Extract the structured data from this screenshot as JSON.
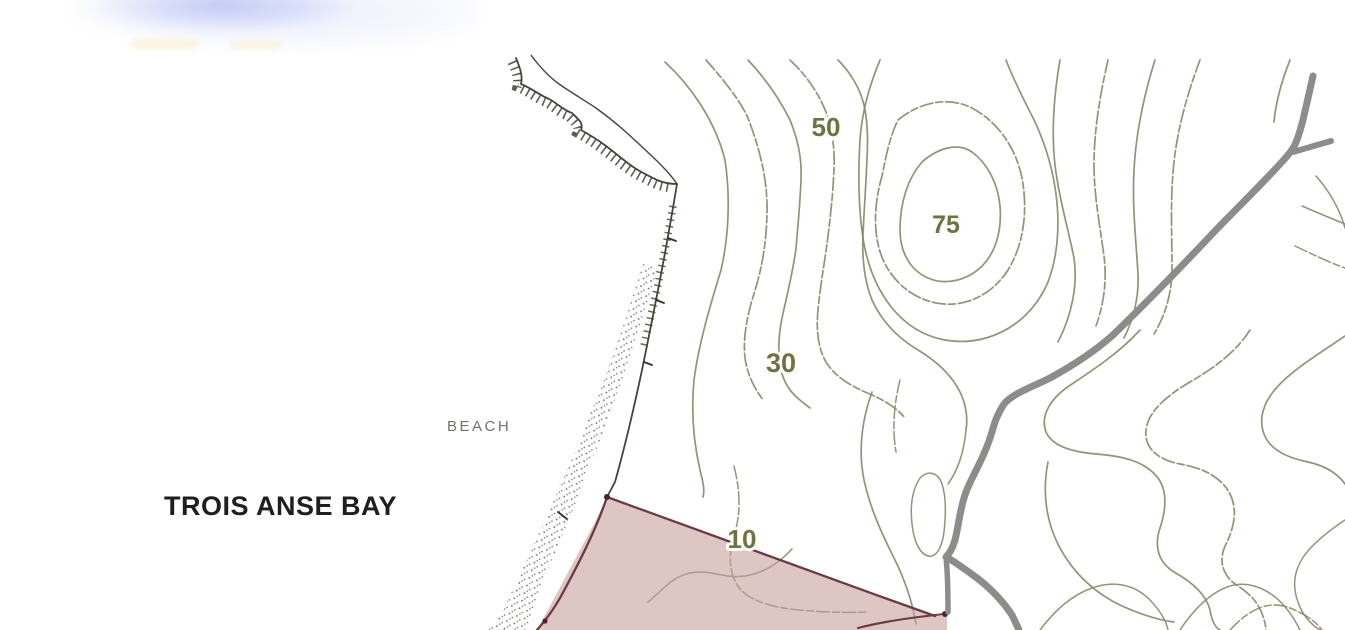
{
  "map": {
    "bay_label": "TROIS ANSE BAY",
    "beach_label": "BEACH",
    "contour_labels": [
      {
        "value": "50"
      },
      {
        "value": "75"
      },
      {
        "value": "30"
      },
      {
        "value": "10"
      }
    ],
    "features": {
      "contour_line_color": "#8a8a6d",
      "contour_label_color": "#6f7244",
      "coastline_color": "#45453e",
      "beach_dot_color": "#63635a",
      "road_color": "#8c8c8a",
      "parcel_fill_color": "#c79d9b",
      "parcel_border_color": "#6b3a45",
      "bay_label_color": "#1f1f1f",
      "beach_label_color": "#73736c"
    },
    "artifacts": {
      "top_left_blur_color": "#94a2ee",
      "smudge_color": "#faeecd"
    }
  }
}
